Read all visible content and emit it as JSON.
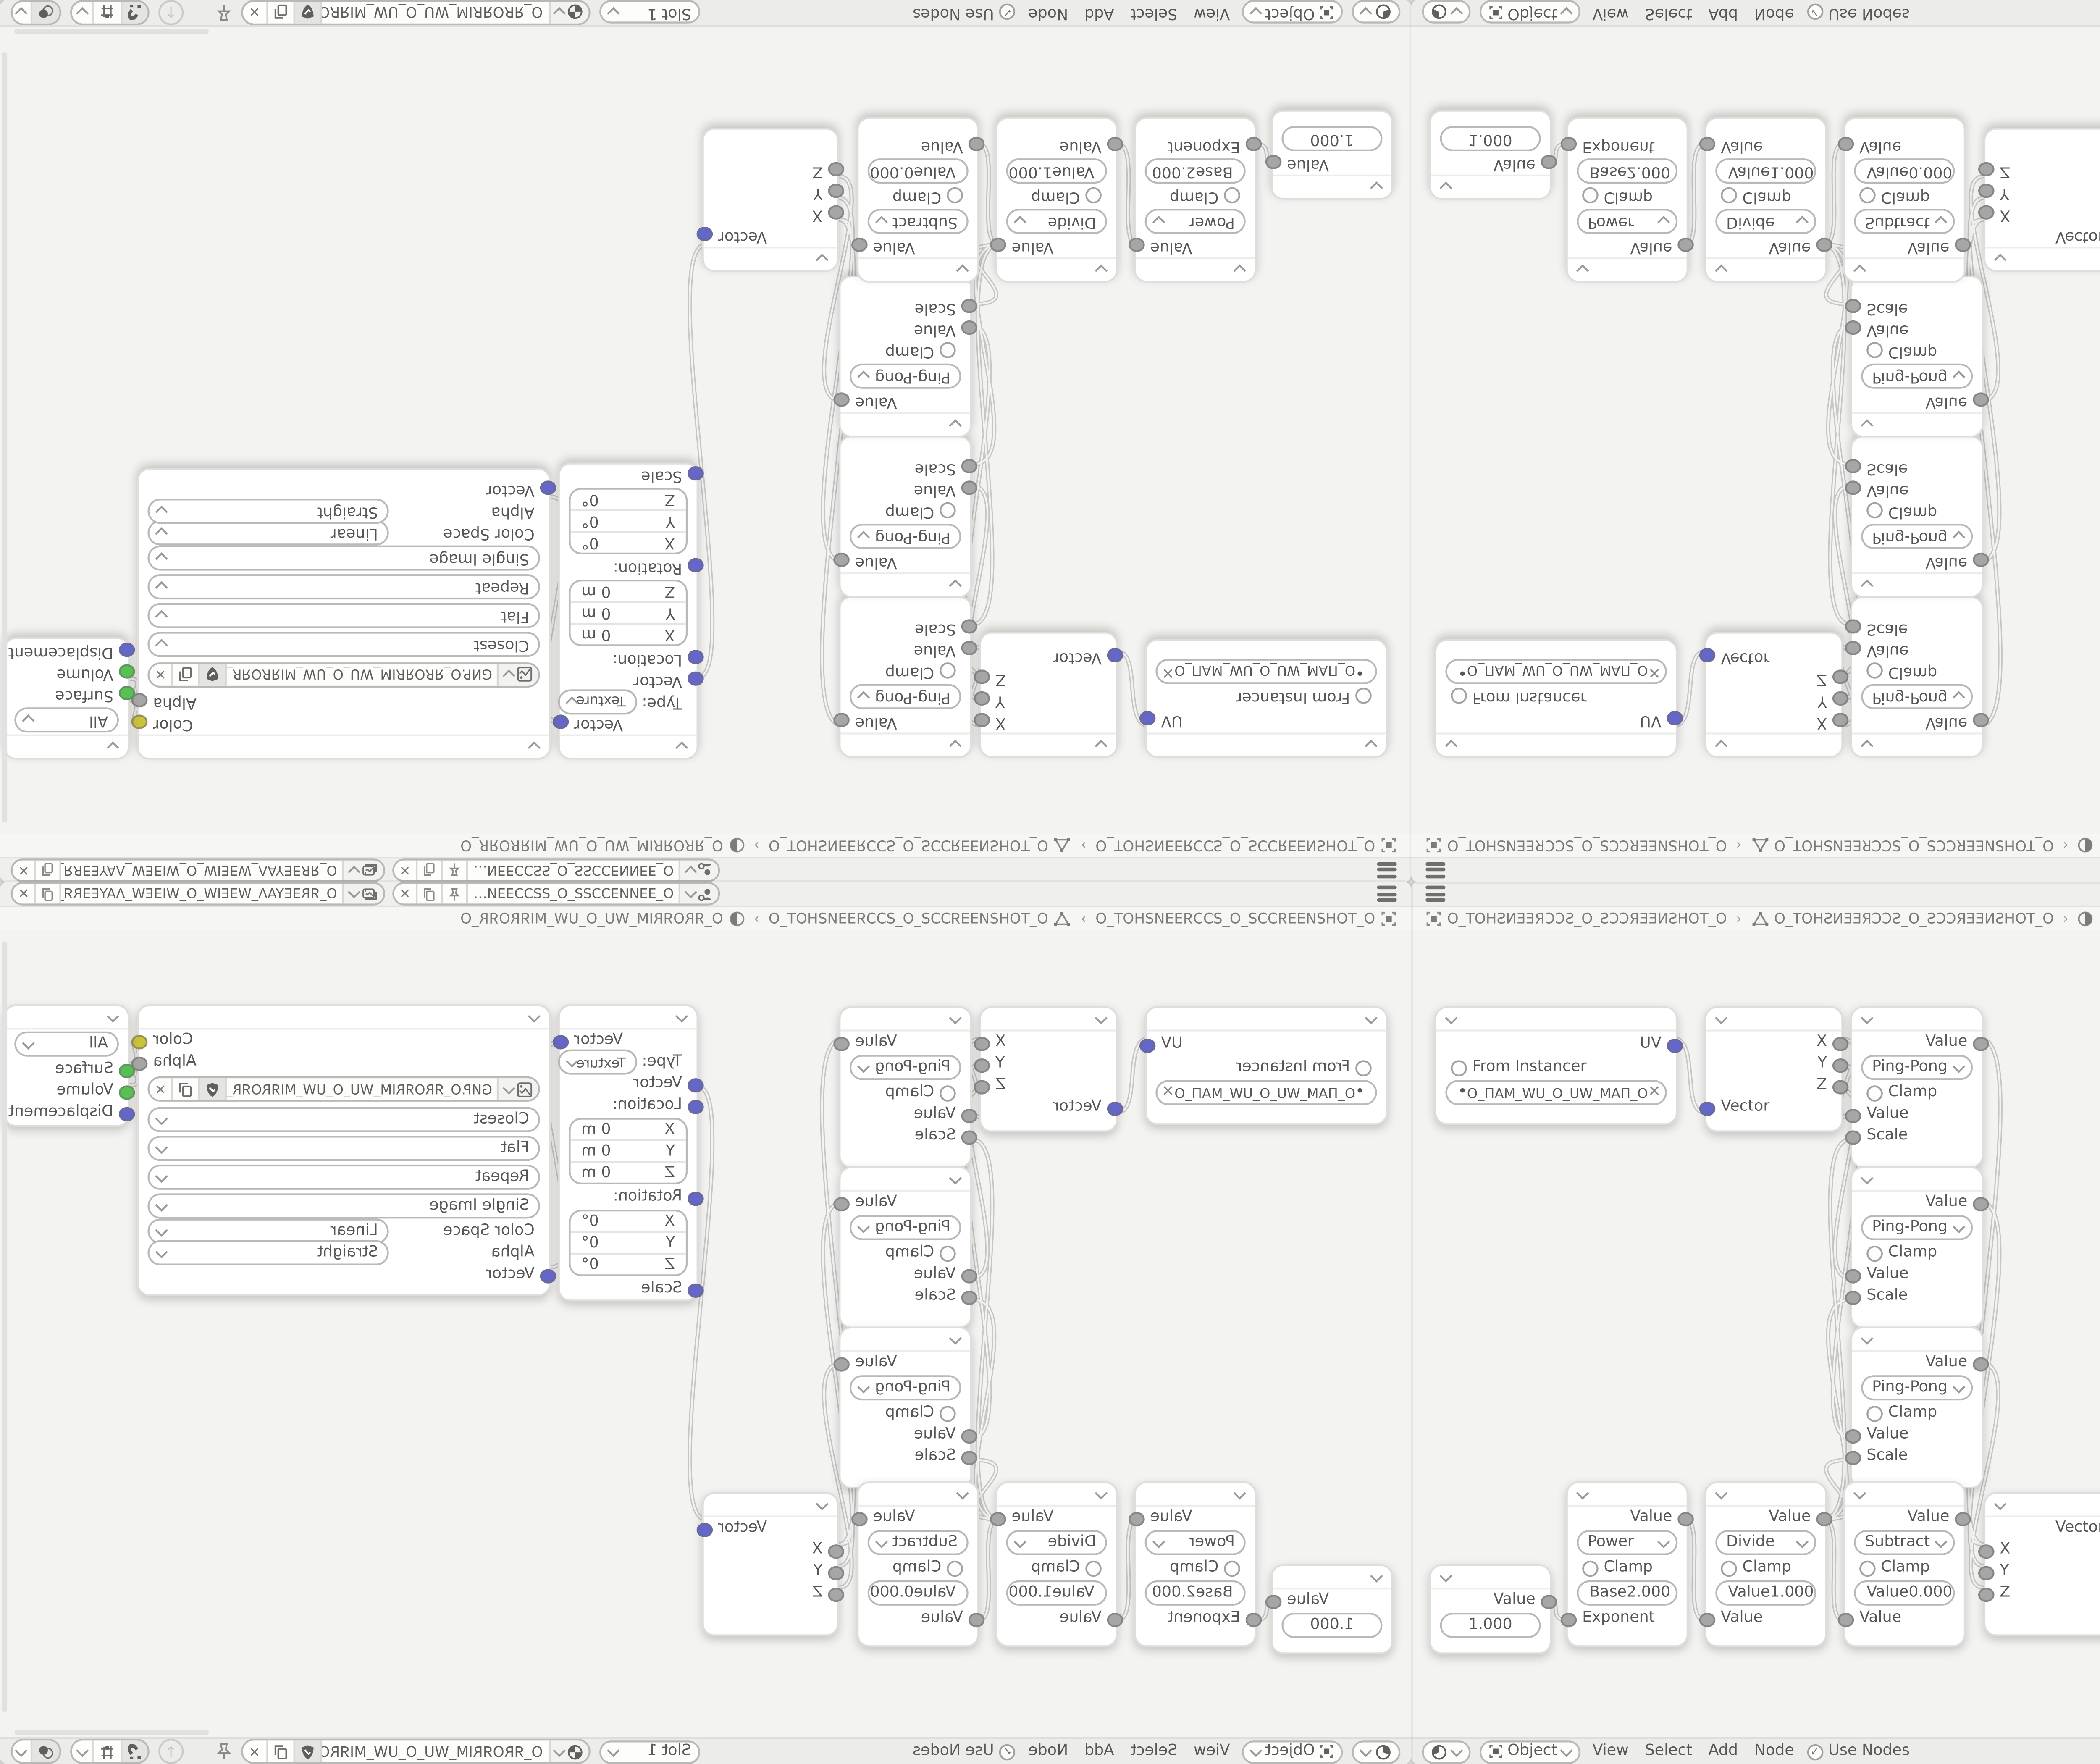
{
  "colors": {
    "socket_vector": "#6467c9",
    "socket_value": "#a6a6a6",
    "socket_color": "#c9c23b",
    "socket_shader": "#57c052",
    "canvas_bg": "#f3f3f1",
    "header_bg": "#ececea"
  },
  "topbar": {
    "scene": {
      "icon": "scene-icon",
      "value": "O_ƎƎИИƎƆƆƧƧ_O_ƧƧƆƆƎƎИ…"
    },
    "view_layer": {
      "icon": "view-layer-icon",
      "value": "O_ЯRƎEYAΛ_WƎEIW_O_WIƎEW_ΛAYEƎRЯ_O"
    }
  },
  "breadcrumb": {
    "separator": "›",
    "items": [
      {
        "icon": "object-icon",
        "label": "O_TOHƧИƎƎЯƆƆƧ_O_ƧƆƆЯƎƎИƧHOT_O"
      },
      {
        "icon": "mesh-data-icon",
        "label": "O_TOHƧИƎƎЯƆƆƧ_O_ƧƆƆЯƎƎИƧHOT_O"
      },
      {
        "icon": "material-icon",
        "label": "O_ЯROЯRIM_WU_O_UW_MIЯROЯR_O"
      }
    ]
  },
  "header": {
    "mode": "Object",
    "menus": [
      "View",
      "Select",
      "Add",
      "Node"
    ],
    "use_nodes_label": "Use Nodes",
    "use_nodes_checked": "true",
    "slot": "Slot 1",
    "material_name": "O_ЯROЯRIM_WU_O_UW_MIЯROЯR_O"
  },
  "nodes": {
    "uv_map": {
      "output": "UV",
      "from_instancer": "From Instancer",
      "uv_name": "O_ПAM_WU_O_UW_MAП_O",
      "clear_label": "✕",
      "dot_label": "•"
    },
    "separate_xyz": {
      "outputs": [
        "X",
        "Y",
        "Z"
      ],
      "input": "Vector"
    },
    "ping_pong": {
      "output": "Value",
      "operation": "Ping-Pong",
      "clamp": "Clamp",
      "inputs": [
        "Value",
        "Scale"
      ]
    },
    "mapping": {
      "output": "Vector",
      "type_label": "Type:",
      "type": "Texture",
      "vector_input": "Vector",
      "location_label": "Location:",
      "rotation_label": "Rotation:",
      "scale_label": "Scale",
      "axes": [
        "X",
        "Y",
        "Z"
      ],
      "location_value": "0 m",
      "rotation_value": "0°"
    },
    "image_texture": {
      "color_output": "Color",
      "alpha_output": "Alpha",
      "filename": "GИP.O_ЯROЯRIM_WU_O_UW_MIЯROЯR_O.PNG",
      "interpolation": "Closest",
      "projection": "Flat",
      "extension": "Repeat",
      "source": "Single Image",
      "color_space_label": "Color Space",
      "color_space": "Linear",
      "alpha_label": "Alpha",
      "alpha_mode": "Straight",
      "input": "Vector"
    },
    "material_output": {
      "target": "All",
      "inputs": [
        "Surface",
        "Volume",
        "Displacement"
      ]
    },
    "value": {
      "output": "Value",
      "value": "1.000"
    },
    "power": {
      "output": "Value",
      "operation": "Power",
      "clamp": "Clamp",
      "field_label": "Base",
      "field_value": "2.000",
      "input": "Exponent"
    },
    "divide": {
      "output": "Value",
      "operation": "Divide",
      "clamp": "Clamp",
      "field_label": "Value",
      "field_value": "1.000",
      "input": "Value"
    },
    "subtract": {
      "output": "Value",
      "operation": "Subtract",
      "clamp": "Clamp",
      "field_label": "Value",
      "field_value": "0.000",
      "input": "Value"
    },
    "combine_xyz": {
      "output": "Vector",
      "inputs": [
        "X",
        "Y",
        "Z"
      ]
    }
  }
}
